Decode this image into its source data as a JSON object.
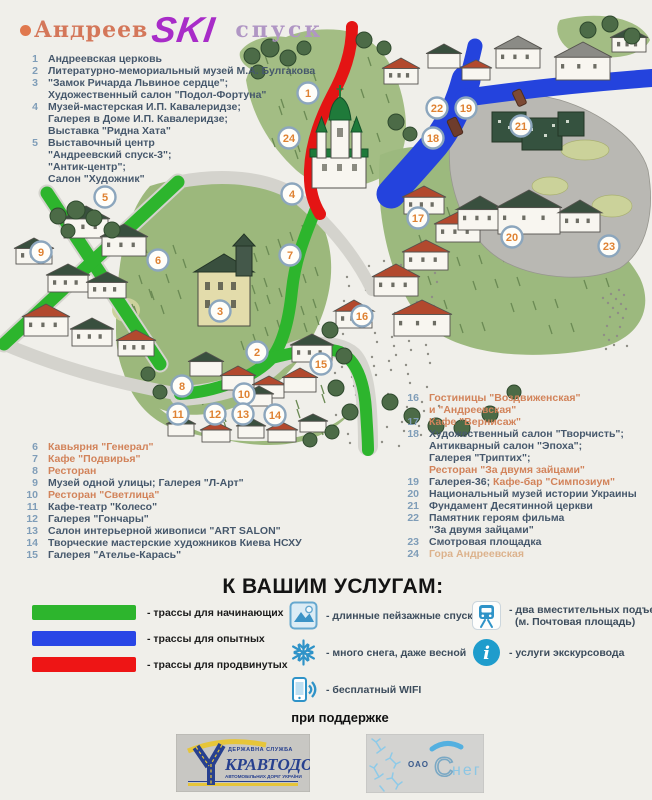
{
  "title": {
    "word1": "Андреев",
    "word2": "SKI",
    "word3": "спуск",
    "bullet_color": "#e0784e",
    "word1_color": "#d4775a",
    "word2_color": "#a82cc8",
    "word3_color": "#b096c4"
  },
  "poi": {
    "group1": [
      {
        "n": "1",
        "lines": [
          [
            {
              "t": "Андреевская церковь",
              "c": "dark"
            }
          ]
        ]
      },
      {
        "n": "2",
        "lines": [
          [
            {
              "t": "Литературно-мемориальный музей М.А. Булгакова",
              "c": "dark"
            }
          ]
        ]
      },
      {
        "n": "3",
        "lines": [
          [
            {
              "t": "\"Замок Ричарда Львиное сердце\";",
              "c": "dark"
            }
          ],
          [
            {
              "t": "Художественный салон \"Подол-Фортуна\"",
              "c": "dark"
            }
          ]
        ]
      },
      {
        "n": "4",
        "lines": [
          [
            {
              "t": "Музей-мастерская И.П. Кавалеридзе;",
              "c": "dark"
            }
          ],
          [
            {
              "t": "Галерея в Доме И.П. Кавалеридзе;",
              "c": "dark"
            }
          ],
          [
            {
              "t": "Выставка \"Ридна Хата\"",
              "c": "dark"
            }
          ]
        ]
      },
      {
        "n": "5",
        "lines": [
          [
            {
              "t": "Выставочный центр",
              "c": "dark"
            }
          ],
          [
            {
              "t": "\"Андреевский спуск-3\";",
              "c": "dark"
            }
          ],
          [
            {
              "t": "\"Антик-центр\";",
              "c": "dark"
            }
          ],
          [
            {
              "t": "Салон \"Художник\"",
              "c": "dark"
            }
          ]
        ]
      }
    ],
    "group2": [
      {
        "n": "6",
        "lines": [
          [
            {
              "t": "Кавьярня \"Генерал\"",
              "c": "orange"
            }
          ]
        ]
      },
      {
        "n": "7",
        "lines": [
          [
            {
              "t": "Кафе \"Подвирья\"",
              "c": "orange"
            }
          ]
        ]
      },
      {
        "n": "8",
        "lines": [
          [
            {
              "t": "Ресторан",
              "c": "orange"
            }
          ]
        ]
      },
      {
        "n": "9",
        "lines": [
          [
            {
              "t": "Музей одной улицы; Галерея \"Л-Арт\"",
              "c": "dark"
            }
          ]
        ]
      },
      {
        "n": "10",
        "lines": [
          [
            {
              "t": "Ресторан \"Светлица\"",
              "c": "orange"
            }
          ]
        ]
      },
      {
        "n": "11",
        "lines": [
          [
            {
              "t": "Кафе-театр \"Колесо\"",
              "c": "dark"
            }
          ]
        ]
      },
      {
        "n": "12",
        "lines": [
          [
            {
              "t": "Галерея \"Гончары\"",
              "c": "dark"
            }
          ]
        ]
      },
      {
        "n": "13",
        "lines": [
          [
            {
              "t": "Салон интерьерной живописи \"ART SALON\"",
              "c": "dark"
            }
          ]
        ]
      },
      {
        "n": "14",
        "lines": [
          [
            {
              "t": "Творческие мастерские художников Киева НСХУ",
              "c": "dark"
            }
          ]
        ]
      },
      {
        "n": "15",
        "lines": [
          [
            {
              "t": "Галерея \"Ателье-Карась\"",
              "c": "dark"
            }
          ]
        ]
      }
    ],
    "group3": [
      {
        "n": "16",
        "lines": [
          [
            {
              "t": "Гостиницы \"Воздвиженская\"",
              "c": "orange"
            }
          ],
          [
            {
              "t": "и \"Андреевская\"",
              "c": "orange"
            }
          ]
        ]
      },
      {
        "n": "17",
        "lines": [
          [
            {
              "t": "Кафе \"Вернисаж\"",
              "c": "orange"
            }
          ]
        ]
      },
      {
        "n": "18",
        "lines": [
          [
            {
              "t": "Художественный салон \"Творчисть\";",
              "c": "dark"
            }
          ],
          [
            {
              "t": "Антикварный салон \"Эпоха\";",
              "c": "dark"
            }
          ],
          [
            {
              "t": "Галерея \"Триптих\";",
              "c": "dark"
            }
          ],
          [
            {
              "t": "Ресторан \"За двумя зайцами\"",
              "c": "orange"
            }
          ]
        ]
      },
      {
        "n": "19",
        "lines": [
          [
            {
              "t": "Галерея-36; ",
              "c": "dark"
            },
            {
              "t": "Кафе-бар \"Симпозиум\"",
              "c": "orange"
            }
          ]
        ]
      },
      {
        "n": "20",
        "lines": [
          [
            {
              "t": "Национальный музей истории Украины",
              "c": "dark"
            }
          ]
        ]
      },
      {
        "n": "21",
        "lines": [
          [
            {
              "t": "Фундамент Десятинной церкви",
              "c": "dark"
            }
          ]
        ]
      },
      {
        "n": "22",
        "lines": [
          [
            {
              "t": "Памятник героям фильма",
              "c": "dark"
            }
          ],
          [
            {
              "t": "\"За двумя зайцами\"",
              "c": "dark"
            }
          ]
        ]
      },
      {
        "n": "23",
        "lines": [
          [
            {
              "t": "Смотровая площадка",
              "c": "dark"
            }
          ]
        ]
      },
      {
        "n": "24",
        "lines": [
          [
            {
              "t": "Гора Андреевская",
              "c": "faded"
            }
          ]
        ]
      }
    ]
  },
  "services": {
    "title": "К ВАШИМ УСЛУГАМ:",
    "routes": [
      {
        "color": "#2db52d",
        "label": "- трассы для начинающих"
      },
      {
        "color": "#2946e6",
        "label": "- трассы для опытных"
      },
      {
        "color": "#ee1515",
        "label": "- трассы для продвинутых"
      }
    ],
    "features": [
      {
        "icon": "mountain-icon",
        "label": "- длинные пейзажные спуски"
      },
      {
        "icon": "snowflake-icon",
        "label": "- много снега, даже весной"
      },
      {
        "icon": "phone-wifi-icon",
        "label": "- бесплатный WIFI"
      }
    ],
    "features2": [
      {
        "icon": "funicular-icon",
        "label": "- два вместительных подъемника",
        "label2": "(м. Почтовая площадь)"
      },
      {
        "icon": "info-icon",
        "label": "- услуги экскурсовода"
      }
    ]
  },
  "sponsors": {
    "heading": "при поддержке",
    "ukravtodor": {
      "line1": "ДЕРЖАВНА СЛУЖБА",
      "name": "КРАВТОДОР",
      "line3": "АВТОМОБІЛЬНИХ ДОРІГ УКРАЇНИ"
    },
    "sneg": {
      "prefix": "ОАО",
      "name_c": "С",
      "name_rest": "нег"
    }
  },
  "map": {
    "marker_number_color": "#df8232",
    "marker_ring_color": "#8ca6bd",
    "route_colors": {
      "beginner": "#2db52d",
      "experienced": "#2443dd",
      "advanced": "#e41414"
    },
    "markers": [
      {
        "n": 1,
        "x": 308,
        "y": 93
      },
      {
        "n": 2,
        "x": 257,
        "y": 352
      },
      {
        "n": 3,
        "x": 220,
        "y": 311
      },
      {
        "n": 4,
        "x": 292,
        "y": 194
      },
      {
        "n": 5,
        "x": 105,
        "y": 197
      },
      {
        "n": 6,
        "x": 158,
        "y": 260
      },
      {
        "n": 7,
        "x": 290,
        "y": 255
      },
      {
        "n": 8,
        "x": 182,
        "y": 386
      },
      {
        "n": 9,
        "x": 41,
        "y": 252
      },
      {
        "n": 10,
        "x": 244,
        "y": 394
      },
      {
        "n": 11,
        "x": 178,
        "y": 414
      },
      {
        "n": 12,
        "x": 215,
        "y": 414
      },
      {
        "n": 13,
        "x": 243,
        "y": 414
      },
      {
        "n": 14,
        "x": 275,
        "y": 415
      },
      {
        "n": 15,
        "x": 321,
        "y": 364
      },
      {
        "n": 16,
        "x": 362,
        "y": 316
      },
      {
        "n": 17,
        "x": 418,
        "y": 218
      },
      {
        "n": 18,
        "x": 433,
        "y": 138
      },
      {
        "n": 19,
        "x": 466,
        "y": 108
      },
      {
        "n": 20,
        "x": 512,
        "y": 237
      },
      {
        "n": 21,
        "x": 521,
        "y": 126
      },
      {
        "n": 22,
        "x": 437,
        "y": 108
      },
      {
        "n": 23,
        "x": 609,
        "y": 246
      },
      {
        "n": 24,
        "x": 289,
        "y": 138
      }
    ]
  }
}
